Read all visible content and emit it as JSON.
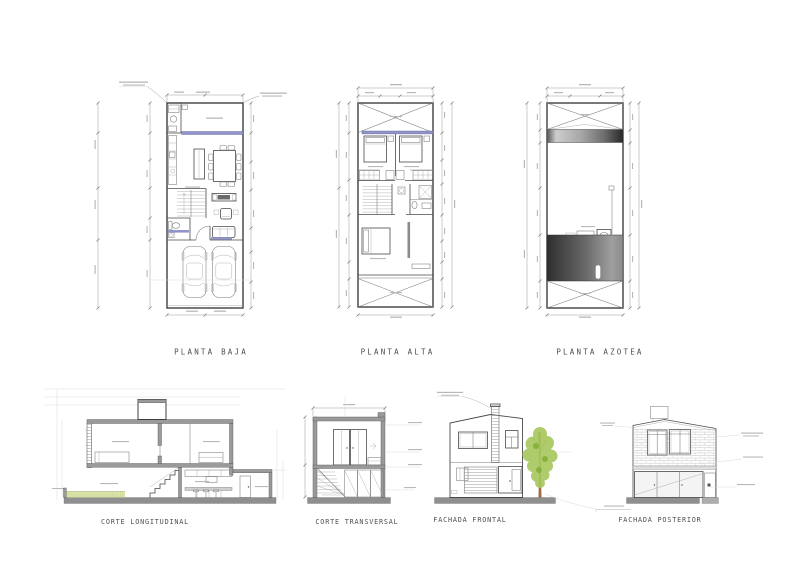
{
  "sheet": {
    "background": "#ffffff"
  },
  "palette": {
    "accent_lavender": "#9295c9",
    "wall_gray": "#9a9a9a",
    "ground_gray": "#8f8f8f",
    "ground_gray_light": "#adadad",
    "grass_green": "#dce3a9",
    "grass_stipple": "#b7c47d",
    "tree_foliage": "#a6c75c",
    "tree_foliage_dark": "#88b23d",
    "tree_trunk": "#996b4b",
    "glass_gray": "#f4f4f4",
    "counter_gray": "#cfcfcf",
    "band_gray": "#dedede",
    "tv_dark": "#6a6a6a"
  },
  "plans": {
    "planta_baja": {
      "label": "PLANTA BAJA"
    },
    "planta_alta": {
      "label": "PLANTA ALTA"
    },
    "planta_azotea": {
      "label": "PLANTA AZOTEA"
    }
  },
  "sections": {
    "corte_longitudinal": {
      "label": "CORTE LONGITUDINAL"
    },
    "corte_transversal": {
      "label": "CORTE TRANSVERSAL"
    }
  },
  "elevations": {
    "fachada_frontal": {
      "label": "FACHADA FRONTAL"
    },
    "fachada_posterior": {
      "label": "FACHADA POSTERIOR"
    }
  }
}
